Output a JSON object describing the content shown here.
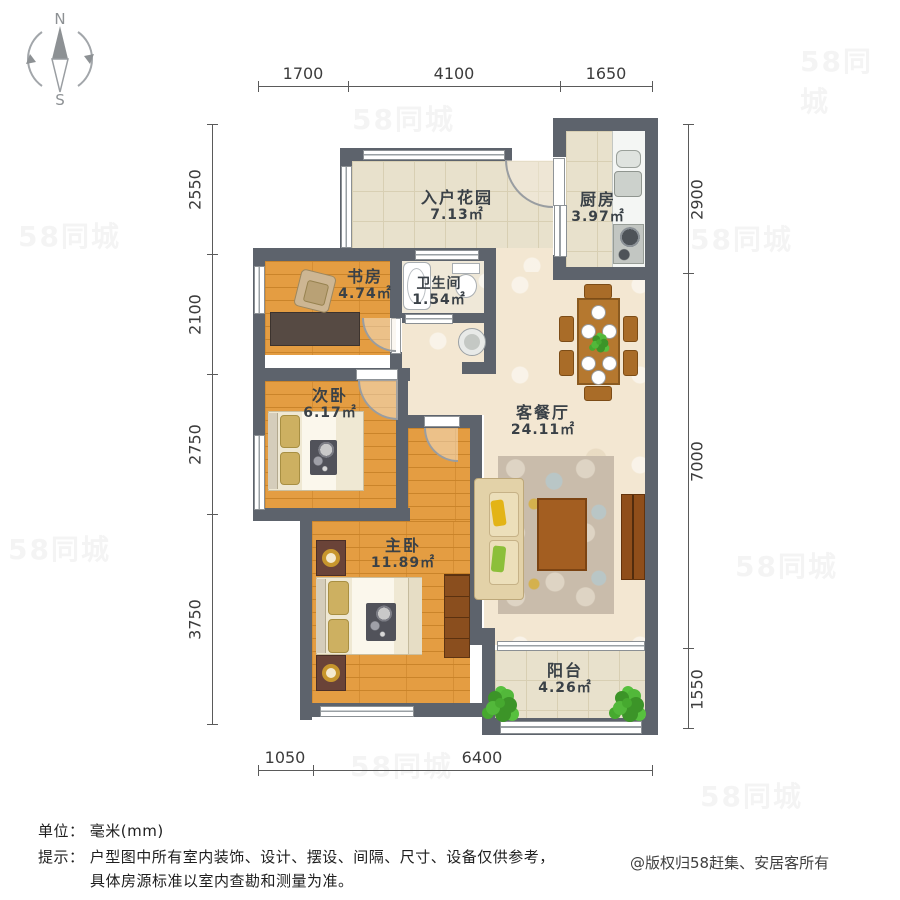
{
  "compass": {
    "north": "N",
    "south": "S"
  },
  "dimensions": {
    "top": [
      "1700",
      "4100",
      "1650"
    ],
    "bottom": [
      "1050",
      "6400"
    ],
    "left": [
      "2550",
      "2100",
      "2750",
      "3750"
    ],
    "right": [
      "2900",
      "7000",
      "1550"
    ]
  },
  "rooms": {
    "entry_garden": {
      "name": "入户花园",
      "area": "7.13㎡"
    },
    "kitchen": {
      "name": "厨房",
      "area": "3.97㎡"
    },
    "study": {
      "name": "书房",
      "area": "4.74㎡"
    },
    "bathroom": {
      "name": "卫生间",
      "area": "1.54㎡"
    },
    "second_bedroom": {
      "name": "次卧",
      "area": "6.17㎡"
    },
    "living_dining": {
      "name": "客餐厅",
      "area": "24.11㎡"
    },
    "master_bedroom": {
      "name": "主卧",
      "area": "11.89㎡"
    },
    "balcony": {
      "name": "阳台",
      "area": "4.26㎡"
    }
  },
  "footer": {
    "unit_label": "单位：",
    "unit_value": "毫米(mm)",
    "tip_label": "提示：",
    "tip_line1": "户型图中所有室内装饰、设计、摆设、间隔、尺寸、设备仅供参考，",
    "tip_line2": "具体房源标准以室内查勘和测量为准。",
    "copyright": "@版权归58赶集、安居客所有"
  },
  "watermark": {
    "text": "58同城"
  },
  "colors": {
    "wall": "#5d636c",
    "wood_floor": "#e49d42",
    "tile_floor": "#e8e1cc",
    "living_floor": "#f3e7d2",
    "bath_floor": "#efe8d8",
    "dim_text": "#3c3c3c",
    "label_text": "#3a4147"
  }
}
